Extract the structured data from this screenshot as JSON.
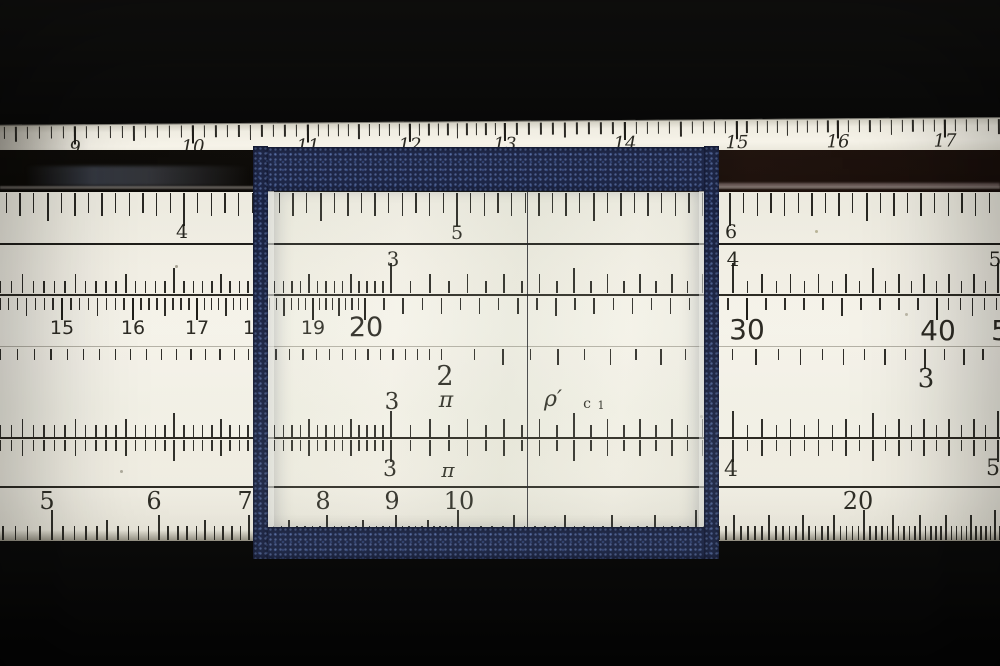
{
  "scene": {
    "kind": "slide-rule-closeup-photo",
    "width": 1000,
    "height": 666
  },
  "colors": {
    "background": "#040404",
    "rule_face": "#f0ede2",
    "ruler_strip": "#f4f1e6",
    "dark_edge": "#0d0a07",
    "tick": "#1a1914",
    "cursor_navy": "#1c2546",
    "hairline": "#23242a",
    "glass_tint": "rgba(175,185,160,0.10)"
  },
  "top_ruler": {
    "strip": {
      "y": 121,
      "h": 38,
      "rotate": -0.45
    },
    "numbers": [
      {
        "t": "9",
        "x": 75,
        "y": 15,
        "s": 18,
        "cls": "serif ital"
      },
      {
        "t": "10",
        "x": 193,
        "y": 15,
        "s": 18,
        "cls": "serif ital"
      },
      {
        "t": "11",
        "x": 308,
        "y": 15,
        "s": 18,
        "cls": "serif ital"
      },
      {
        "t": "12",
        "x": 410,
        "y": 15,
        "s": 18,
        "cls": "serif ital"
      },
      {
        "t": "13",
        "x": 505,
        "y": 15,
        "s": 18,
        "cls": "serif ital"
      },
      {
        "t": "14",
        "x": 625,
        "y": 15,
        "s": 18,
        "cls": "serif ital"
      },
      {
        "t": "15",
        "x": 737,
        "y": 15,
        "s": 18,
        "cls": "serif ital"
      },
      {
        "t": "16",
        "x": 838,
        "y": 15,
        "s": 18,
        "cls": "serif ital"
      },
      {
        "t": "17",
        "x": 945,
        "y": 15,
        "s": 18,
        "cls": "serif ital"
      }
    ],
    "ticks": {
      "type": "anchors",
      "yA": 2,
      "dir": "down",
      "xOff": 6,
      "gaps": [
        [
          -43,
          75,
          10
        ],
        [
          75,
          193,
          10
        ],
        [
          193,
          308,
          10
        ],
        [
          308,
          410,
          10
        ],
        [
          410,
          505,
          10
        ],
        [
          505,
          625,
          10
        ],
        [
          625,
          737,
          10
        ],
        [
          737,
          838,
          10
        ],
        [
          838,
          945,
          10
        ],
        [
          945,
          1053,
          10
        ]
      ],
      "h": {
        "minor": 12,
        "mid": 15,
        "anchor": 18
      }
    }
  },
  "bands": [
    {
      "name": "upper-mantissa-scale",
      "dir": "down",
      "yA": 193,
      "numbers": [
        {
          "t": "4",
          "x": 182,
          "y": 223,
          "s": 19,
          "cls": "serif"
        },
        {
          "t": "5",
          "x": 457,
          "y": 224,
          "s": 19,
          "cls": "serif"
        },
        {
          "t": "6",
          "x": 731,
          "y": 223,
          "s": 19,
          "cls": "serif"
        }
      ],
      "ticks": {
        "type": "linear",
        "xRef": 457,
        "vRef": 5,
        "pxPerUnit": 273,
        "v0": 3.35,
        "v1": 6.99,
        "step": 0.05,
        "h": {
          "minor": 20,
          "tenth": 23,
          "half": 28,
          "int": 33
        }
      }
    },
    {
      "name": "upper-stator-C-scale",
      "dir": "up",
      "yA": 293,
      "numbers": [
        {
          "t": "3",
          "x": 393,
          "y": 249,
          "s": 20,
          "cls": "serif"
        },
        {
          "t": "4",
          "x": 733,
          "y": 249,
          "s": 20,
          "cls": "serif"
        },
        {
          "t": "5",
          "x": 995,
          "y": 249,
          "s": 20,
          "cls": "serif"
        }
      ],
      "ticks": {
        "type": "log",
        "xRef": 391,
        "vRef": 3,
        "D": 2735,
        "segs": [
          [
            2.16,
            3,
            0.02
          ],
          [
            3,
            5.03,
            0.05
          ]
        ],
        "h": {
          "minor": 12,
          "tenth": 19,
          "half": 25,
          "int": 30
        }
      }
    },
    {
      "name": "slide-top-scale",
      "dir": "down",
      "yA": 298,
      "numbers": [
        {
          "t": "15",
          "x": 62,
          "y": 319,
          "s": 19,
          "cls": "sans"
        },
        {
          "t": "16",
          "x": 133,
          "y": 319,
          "s": 19,
          "cls": "sans"
        },
        {
          "t": "17",
          "x": 197,
          "y": 319,
          "s": 19,
          "cls": "sans"
        },
        {
          "t": "18",
          "x": 255,
          "y": 319,
          "s": 19,
          "cls": "sans"
        },
        {
          "t": "19",
          "x": 313,
          "y": 319,
          "s": 19,
          "cls": "sans"
        },
        {
          "t": "20",
          "x": 366,
          "y": 314,
          "s": 27,
          "cls": "sans"
        },
        {
          "t": "30",
          "x": 747,
          "y": 316,
          "s": 28,
          "cls": "sans"
        },
        {
          "t": "40",
          "x": 938,
          "y": 317,
          "s": 28,
          "cls": "sans"
        },
        {
          "t": "50",
          "x": 1009,
          "y": 317,
          "s": 28,
          "cls": "sans"
        }
      ],
      "ticks": {
        "type": "anchors",
        "xOff": 0,
        "gaps": [
          [
            -9,
            62,
            8
          ],
          [
            62,
            133,
            8
          ],
          [
            133,
            197,
            8
          ],
          [
            197,
            255,
            8
          ],
          [
            255,
            313,
            8
          ],
          [
            313,
            365,
            8
          ],
          [
            365,
            747,
            20
          ],
          [
            747,
            937,
            10
          ],
          [
            937,
            1008,
            6
          ]
        ],
        "h": {
          "minor": 12,
          "mid": 18,
          "mid2": 16,
          "anchor": 22
        }
      }
    },
    {
      "name": "slide-middle-scale",
      "dir": "down",
      "yA": 349,
      "numbers": [
        {
          "t": "2",
          "x": 445,
          "y": 363,
          "s": 27,
          "cls": "serif"
        },
        {
          "t": "3",
          "x": 926,
          "y": 366,
          "s": 26,
          "cls": "serif"
        }
      ],
      "ticks": {
        "type": "log",
        "xRef": 445,
        "vRef": 2,
        "D": 2727,
        "segs": [
          [
            1.374,
            2,
            0.02
          ],
          [
            2,
            3.2,
            0.05
          ]
        ],
        "h": {
          "minor": 11,
          "tenth": 16,
          "half": 22,
          "int": 20
        }
      }
    },
    {
      "name": "slide-bottom-C-scale",
      "dir": "up",
      "yA": 437,
      "numbers": [
        {
          "t": "3",
          "x": 392,
          "y": 391,
          "s": 23,
          "cls": "serif"
        },
        {
          "t": "π",
          "x": 446,
          "y": 390,
          "s": 22,
          "cls": "serif ital",
          "name": "pi-gauge-mark"
        },
        {
          "t": "ρ′",
          "x": 553,
          "y": 389,
          "s": 22,
          "cls": "serif ital",
          "name": "rho-gauge-mark"
        },
        {
          "t": "c",
          "x": 587,
          "y": 397,
          "s": 14,
          "cls": "serif",
          "name": "c1-gauge-mark"
        },
        {
          "t": "1",
          "x": 601,
          "y": 400,
          "s": 11,
          "cls": "serif",
          "name": "c1-gauge-mark"
        }
      ],
      "ticks": {
        "type": "log",
        "xRef": 391,
        "vRef": 3,
        "D": 2735,
        "segs": [
          [
            2.16,
            3,
            0.02
          ],
          [
            3,
            5.03,
            0.05
          ]
        ],
        "h": {
          "minor": 12,
          "tenth": 18,
          "half": 24,
          "int": 26
        }
      }
    },
    {
      "name": "lower-stator-D-scale",
      "dir": "down",
      "yA": 440,
      "numbers": [
        {
          "t": "3",
          "x": 390,
          "y": 459,
          "s": 22,
          "cls": "serif"
        },
        {
          "t": "π",
          "x": 448,
          "y": 460,
          "s": 20,
          "cls": "serif ital",
          "name": "pi-gauge-mark"
        },
        {
          "t": "4",
          "x": 731,
          "y": 459,
          "s": 22,
          "cls": "serif"
        },
        {
          "t": "5",
          "x": 993,
          "y": 458,
          "s": 22,
          "cls": "serif"
        }
      ],
      "ticks": {
        "type": "log",
        "xRef": 391,
        "vRef": 3,
        "D": 2735,
        "segs": [
          [
            2.16,
            3,
            0.02
          ],
          [
            3,
            5.03,
            0.05
          ]
        ],
        "h": {
          "minor": 11,
          "tenth": 16,
          "half": 21,
          "int": 22
        }
      }
    },
    {
      "name": "bottom-edge-A-scale",
      "dir": "up",
      "yA": 540,
      "numbers": [
        {
          "t": "5",
          "x": 47,
          "y": 489,
          "s": 24,
          "cls": "serif"
        },
        {
          "t": "6",
          "x": 154,
          "y": 489,
          "s": 24,
          "cls": "serif"
        },
        {
          "t": "7",
          "x": 245,
          "y": 489,
          "s": 24,
          "cls": "serif"
        },
        {
          "t": "8",
          "x": 323,
          "y": 489,
          "s": 24,
          "cls": "serif"
        },
        {
          "t": "9",
          "x": 392,
          "y": 489,
          "s": 24,
          "cls": "serif"
        },
        {
          "t": "10",
          "x": 459,
          "y": 489,
          "s": 24,
          "cls": "serif"
        },
        {
          "t": "20",
          "x": 858,
          "y": 489,
          "s": 24,
          "cls": "serif"
        }
      ],
      "ticks": {
        "type": "log",
        "xRef": 458,
        "vRef": 10,
        "D": 1350,
        "segs": [
          [
            4.6,
            10,
            0.1
          ],
          [
            10,
            25.2,
            0.2
          ]
        ],
        "h": {
          "minor": 14,
          "tenth": 14,
          "half": 20,
          "int": 25,
          "five": 30
        }
      }
    }
  ],
  "lines": [
    {
      "y": 243,
      "h": 1.6,
      "c": "#1d1c18"
    },
    {
      "y": 294,
      "h": 2,
      "c": "#2a2822"
    },
    {
      "y": 346,
      "h": 1,
      "c": "rgba(75,70,55,0.5)"
    },
    {
      "y": 437,
      "h": 2,
      "c": "#232019"
    },
    {
      "y": 486,
      "h": 1.6,
      "c": "#25231d"
    }
  ],
  "cursor": {
    "frame": {
      "x": 253,
      "y": 146,
      "w": 466,
      "h": 413
    },
    "left_bar": {
      "x": 0,
      "w": 15
    },
    "right_bar": {
      "x": 451,
      "w": 15
    },
    "top_rail": {
      "y": 1,
      "h": 44
    },
    "bottom_rail": {
      "y": 381,
      "h": 32
    },
    "glass": {
      "x": 15,
      "y": 45,
      "w": 437,
      "h": 336
    },
    "hairline_x": 273.5
  }
}
